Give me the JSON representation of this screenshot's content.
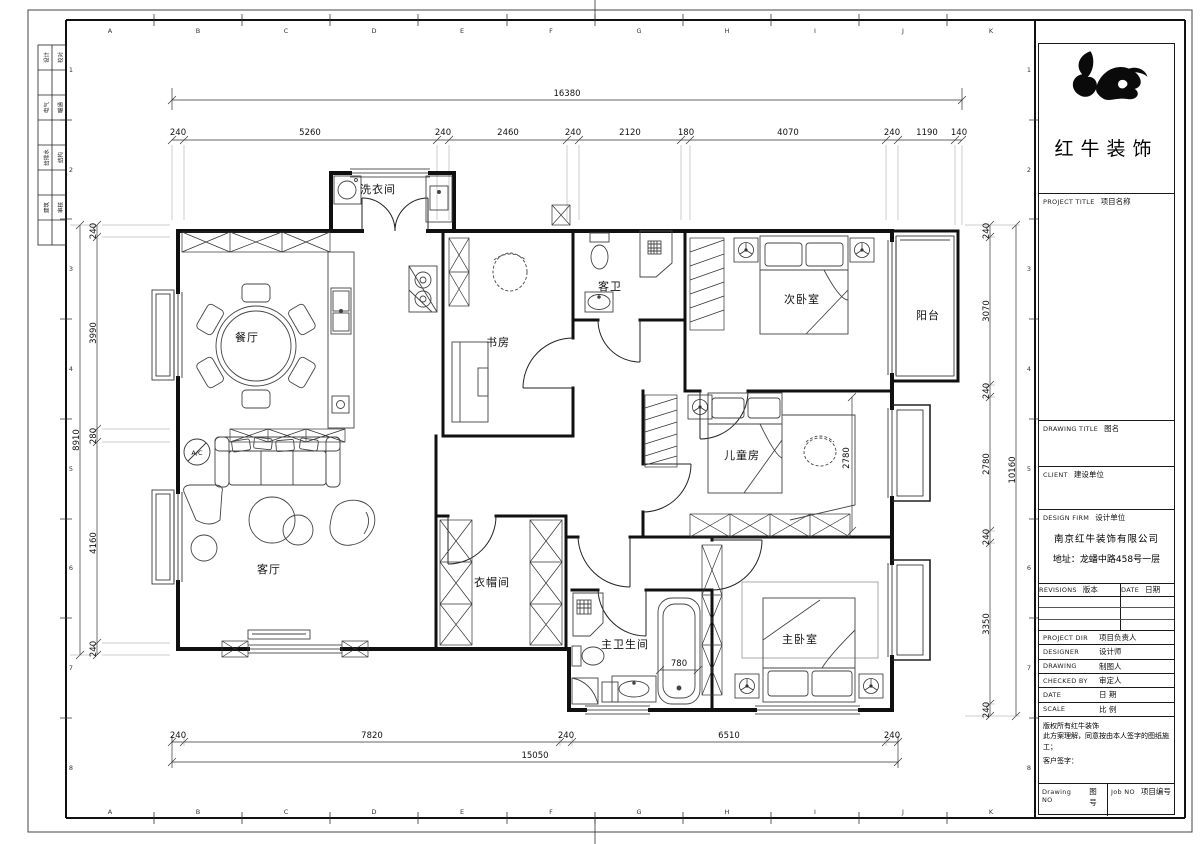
{
  "sheet": {
    "grid_letters": [
      "A",
      "B",
      "C",
      "D",
      "E",
      "F",
      "G",
      "H",
      "I",
      "J",
      "K"
    ],
    "grid_numbers": [
      "1",
      "2",
      "3",
      "4",
      "5",
      "6",
      "7",
      "8"
    ],
    "signoff": [
      {
        "l": "设计",
        "r": "校对"
      },
      {
        "l": "电气",
        "r": "暖通"
      },
      {
        "l": "给排水",
        "r": "结构"
      },
      {
        "l": "建筑",
        "r": "审核"
      }
    ]
  },
  "plan": {
    "rooms": {
      "laundry": "洗衣间",
      "dining": "餐厅",
      "study": "书房",
      "guest_bath": "客卫",
      "second_bedroom": "次卧室",
      "balcony": "阳台",
      "children_room": "儿童房",
      "living": "客厅",
      "cloakroom": "衣帽间",
      "master_bath": "主卫生间",
      "master_bedroom": "主卧室"
    },
    "ac_label": "A/C"
  },
  "dims": {
    "top": {
      "total": "16380",
      "segments": [
        "240",
        "5260",
        "240",
        "2460",
        "240",
        "2120",
        "180",
        "4070",
        "240",
        "1190",
        "140"
      ]
    },
    "bottom": {
      "total": "15050",
      "segments": [
        "240",
        "7820",
        "240",
        "6510",
        "240"
      ]
    },
    "left": {
      "total": "8910",
      "segments": [
        "240",
        "3990",
        "280",
        "4160",
        "240"
      ]
    },
    "right": {
      "total": "10160",
      "segments": [
        "240",
        "3070",
        "240",
        "2780",
        "240",
        "3350",
        "240"
      ]
    },
    "inner": {
      "children_depth": "2780",
      "tub": "780"
    }
  },
  "title_block": {
    "brand": "红牛装饰",
    "project_title_en": "PROJECT TITLE",
    "project_title_cn": "项目名称",
    "drawing_title_en": "DRAWING TITLE",
    "drawing_title_cn": "图名",
    "client_en": "CLIENT",
    "client_cn": "建设单位",
    "design_firm_en": "DESIGN FIRM",
    "design_firm_cn": "设计单位",
    "company": "南京红牛装饰有限公司",
    "address": "地址：龙蟠中路458号一层",
    "revisions_en": "REVISIONS",
    "revisions_cn": "版本",
    "date_col_en": "DATE",
    "date_col_cn": "日期",
    "rows": [
      {
        "en": "PROJECT DIR",
        "cn": "项目负责人"
      },
      {
        "en": "DESIGNER",
        "cn": "设计师"
      },
      {
        "en": "DRAWING",
        "cn": "制图人"
      },
      {
        "en": "CHECKED BY",
        "cn": "审定人"
      },
      {
        "en": "DATE",
        "cn": "日  期"
      },
      {
        "en": "SCALE",
        "cn": "比  例"
      }
    ],
    "copyright_1": "版权所有红牛装饰",
    "copyright_2": "此方案理解，同意按由本人签字的图纸施工；",
    "copyright_3": "客户签字：",
    "drawing_no_en": "Drawing NO",
    "drawing_no_cn": "图号",
    "job_no_en": "Job NO",
    "job_no_cn": "项目编号"
  }
}
